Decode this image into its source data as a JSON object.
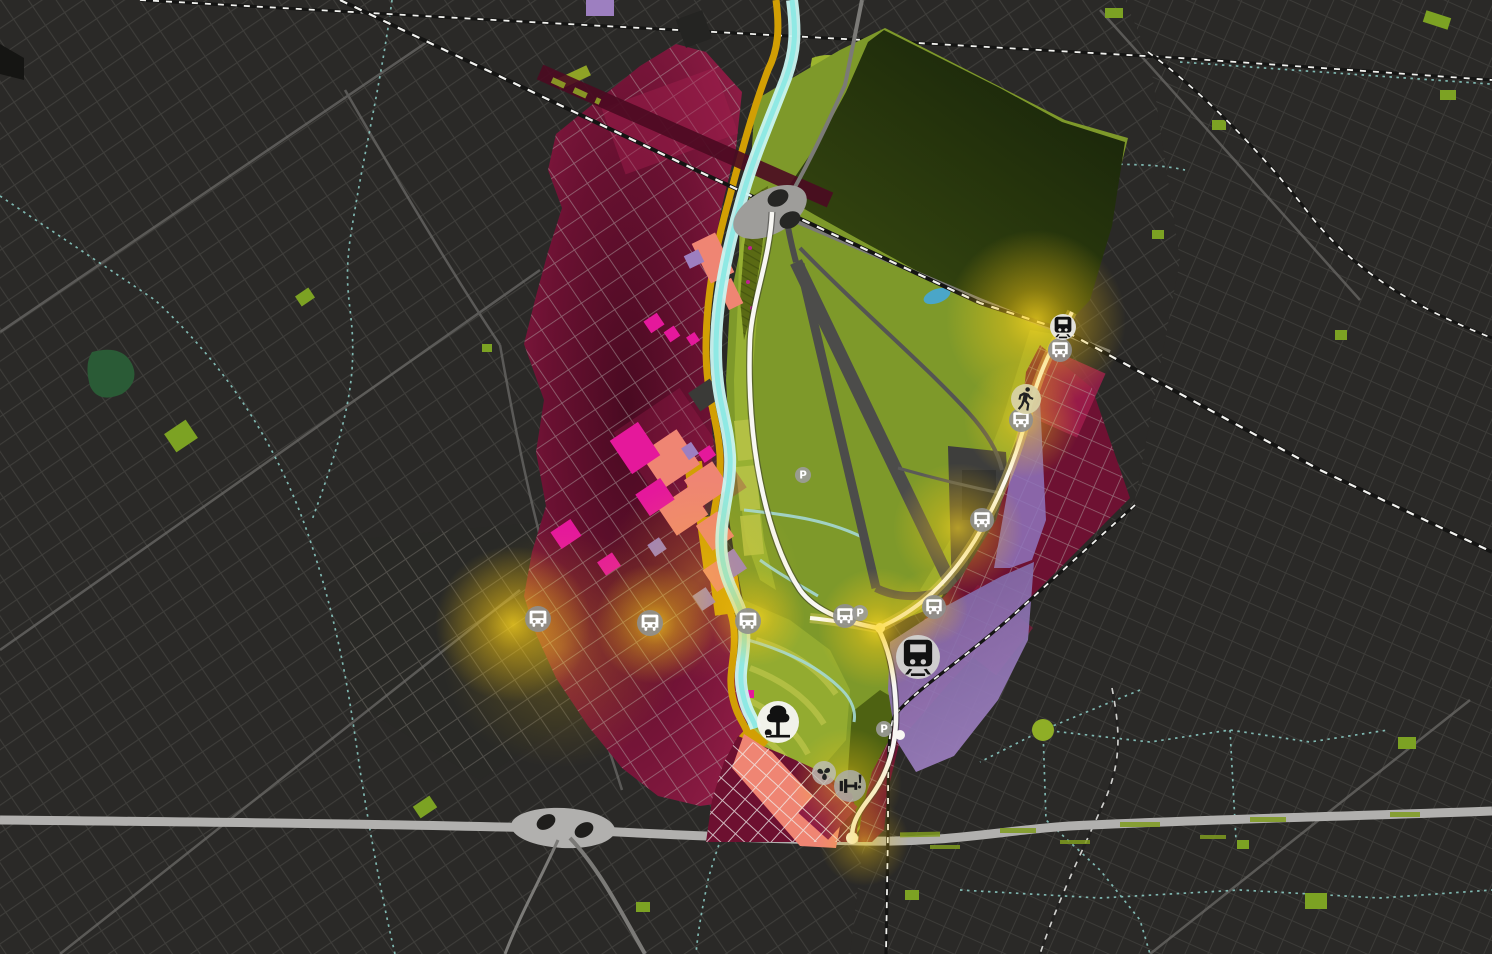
{
  "map": {
    "kind": "urban-masterplan-map",
    "theme": "dark",
    "visible_text": [
      "P"
    ]
  },
  "palette": {
    "bg": "#2a2927",
    "bgLine": "#403f3c",
    "bgLineR": "#3d3c39",
    "bgLineLight": "#56544f",
    "avenue": "#6b6a67",
    "highway": "#b1b0ae",
    "roadGray": "#7b7a77",
    "roadWhite": "#f8f7f3",
    "roadCream": "#fdfaee",
    "creamGlow": "#f3d96b",
    "railDark": "#141413",
    "railWhite": "#f2f2ef",
    "stream": "#8fd2cb",
    "river": "#c9f6f2",
    "riverCore": "#8fe9e4",
    "creek": "#a5d8d4",
    "pond": "#4aa6c8",
    "crimsonDark": "#490a21",
    "crimson": "#6b1132",
    "crimsonBright": "#8e1c45",
    "crimsonPatch": "#a21e4e",
    "magenta": "#e5189b",
    "salmon": "#ef8573",
    "purple": "#77629f",
    "purpleLight": "#9d7fc0",
    "gold": "#d29f04",
    "green": "#7e992a",
    "greenBright": "#9ab233",
    "greenTerrace": "#b9c348",
    "greenDark": "#4e6212",
    "parkDark1": "#17230a",
    "parkDark2": "#3c4e10",
    "patchGreen": "#7ca223",
    "forest": "#2a5b36",
    "runway": "#4c4c4a",
    "apron": "#3e3e3c",
    "terminal": "#333331",
    "glow": "#f7c813",
    "gridCrimson": "#b7b2ae",
    "gridWhite": "#f0efec",
    "darkBlock": "#242422"
  },
  "markers": [
    {
      "icon": "bus",
      "name": "bus-stop",
      "x": 538,
      "y": 619,
      "r": 13,
      "bg": "#8f8f8d",
      "o": 0.92,
      "fg": "#ffffff"
    },
    {
      "icon": "bus",
      "name": "bus-stop",
      "x": 650,
      "y": 623,
      "r": 13,
      "bg": "#8f8f8d",
      "o": 0.92,
      "fg": "#ffffff"
    },
    {
      "icon": "bus",
      "name": "bus-stop",
      "x": 748,
      "y": 621,
      "r": 13,
      "bg": "#8f8f8d",
      "o": 0.92,
      "fg": "#ffffff"
    },
    {
      "icon": "bus",
      "name": "bus-stop",
      "x": 845,
      "y": 616,
      "r": 12,
      "bg": "#8f8f8d",
      "o": 0.92,
      "fg": "#ffffff"
    },
    {
      "icon": "bus",
      "name": "bus-stop",
      "x": 934,
      "y": 607,
      "r": 12,
      "bg": "#8f8f8d",
      "o": 0.92,
      "fg": "#ffffff"
    },
    {
      "icon": "bus",
      "name": "bus-stop",
      "x": 982,
      "y": 520,
      "r": 12,
      "bg": "#8f8f8d",
      "o": 0.92,
      "fg": "#ffffff"
    },
    {
      "icon": "bus",
      "name": "bus-stop",
      "x": 1021,
      "y": 420,
      "r": 12,
      "bg": "#8f8f8d",
      "o": 0.92,
      "fg": "#ffffff"
    },
    {
      "icon": "bus",
      "name": "bus-stop",
      "x": 1060,
      "y": 350,
      "r": 12,
      "bg": "#8f8f8d",
      "o": 0.92,
      "fg": "#ffffff"
    },
    {
      "icon": "train",
      "name": "train-station",
      "x": 918,
      "y": 657,
      "r": 22,
      "bg": "#d2d2d0",
      "o": 0.95,
      "fg": "#111111"
    },
    {
      "icon": "train",
      "name": "rail-station",
      "x": 1063,
      "y": 327,
      "r": 13,
      "bg": "#e8e8e6",
      "o": 0.95,
      "fg": "#111111"
    },
    {
      "icon": "walk",
      "name": "pedestrian-area",
      "x": 1026,
      "y": 399,
      "r": 15,
      "bg": "#d8d2a4",
      "o": 0.95,
      "fg": "#222222"
    },
    {
      "icon": "tree",
      "name": "park-poi",
      "x": 778,
      "y": 722,
      "r": 21,
      "bg": "#f4f4f1",
      "o": 0.97,
      "fg": "#111111"
    },
    {
      "icon": "pinwheel",
      "name": "playground-poi",
      "x": 824,
      "y": 773,
      "r": 12,
      "bg": "#bebeba",
      "o": 0.8,
      "fg": "#222222"
    },
    {
      "icon": "fitness",
      "name": "fitness-poi",
      "x": 850,
      "y": 786,
      "r": 16,
      "bg": "#ababa8",
      "o": 0.85,
      "fg": "#1a1a1a"
    },
    {
      "icon": "parking",
      "name": "parking",
      "x": 803,
      "y": 475,
      "r": 8,
      "bg": "#9c9c9a",
      "o": 0.9,
      "fg": "#ffffff",
      "label": "P"
    },
    {
      "icon": "parking",
      "name": "parking",
      "x": 860,
      "y": 613,
      "r": 8,
      "bg": "#9c9c9a",
      "o": 0.9,
      "fg": "#ffffff",
      "label": "P"
    },
    {
      "icon": "parking",
      "name": "parking",
      "x": 884,
      "y": 729,
      "r": 8,
      "bg": "#9c9c9a",
      "o": 0.9,
      "fg": "#ffffff",
      "label": "P"
    }
  ],
  "glows": [
    {
      "x": 513,
      "y": 624,
      "r": 78,
      "o": 0.8
    },
    {
      "x": 560,
      "y": 648,
      "r": 120,
      "o": 0.3
    },
    {
      "x": 655,
      "y": 624,
      "r": 60,
      "o": 0.75
    },
    {
      "x": 757,
      "y": 618,
      "r": 48,
      "o": 0.7
    },
    {
      "x": 700,
      "y": 580,
      "r": 100,
      "o": 0.3
    },
    {
      "x": 878,
      "y": 628,
      "r": 60,
      "o": 0.8
    },
    {
      "x": 930,
      "y": 608,
      "r": 38,
      "o": 0.5
    },
    {
      "x": 847,
      "y": 783,
      "r": 55,
      "o": 0.55
    },
    {
      "x": 864,
      "y": 841,
      "r": 45,
      "o": 0.55
    },
    {
      "x": 958,
      "y": 528,
      "r": 65,
      "o": 0.65
    },
    {
      "x": 1022,
      "y": 420,
      "r": 58,
      "o": 0.65
    },
    {
      "x": 1036,
      "y": 320,
      "r": 90,
      "o": 0.8
    }
  ]
}
